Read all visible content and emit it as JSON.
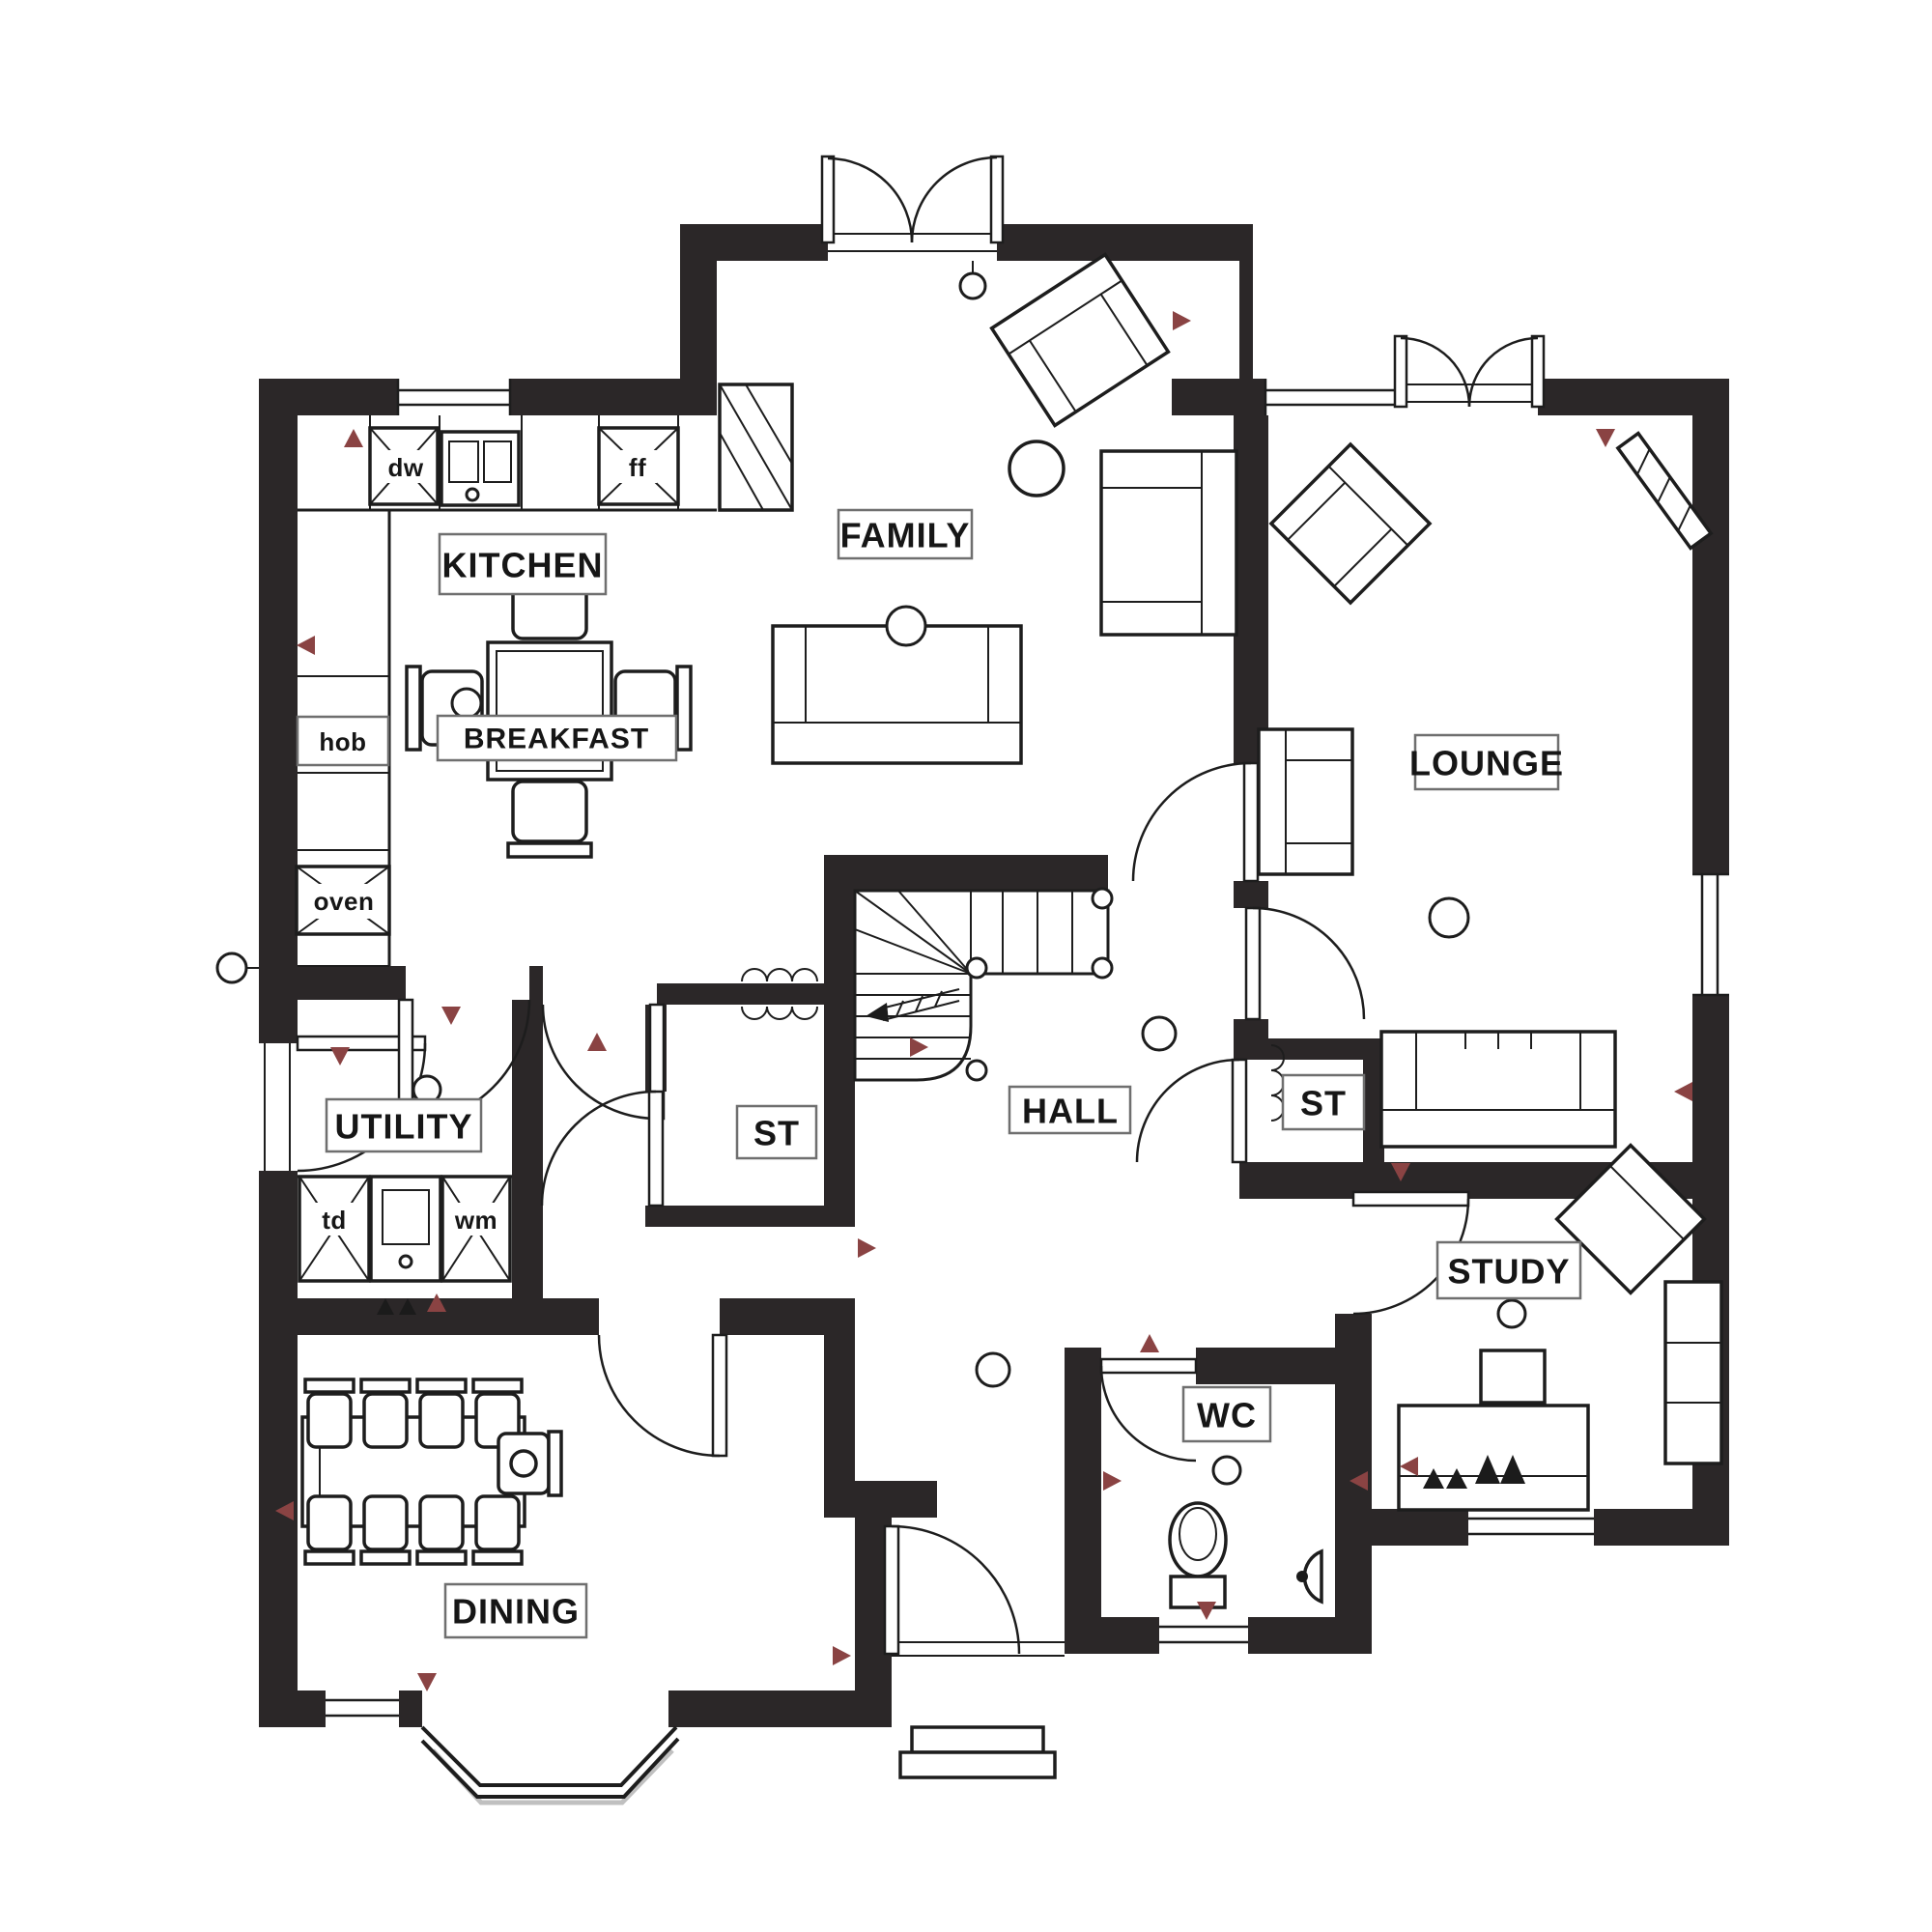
{
  "colors": {
    "wall": "#2b2728",
    "line": "#1d1d1d",
    "accent_marker": "#8a4343",
    "label_border": "#6f6f6f"
  },
  "rooms": [
    {
      "id": "kitchen",
      "label": "KITCHEN"
    },
    {
      "id": "breakfast",
      "label": "BREAKFAST"
    },
    {
      "id": "family",
      "label": "FAMILY"
    },
    {
      "id": "lounge",
      "label": "LOUNGE"
    },
    {
      "id": "utility",
      "label": "UTILITY"
    },
    {
      "id": "store-left",
      "label": "ST"
    },
    {
      "id": "store-right",
      "label": "ST"
    },
    {
      "id": "hall",
      "label": "HALL"
    },
    {
      "id": "wc",
      "label": "WC"
    },
    {
      "id": "dining",
      "label": "DINING"
    },
    {
      "id": "study",
      "label": "STUDY"
    }
  ],
  "appliances": [
    {
      "id": "hob",
      "label": "hob"
    },
    {
      "id": "oven",
      "label": "oven"
    },
    {
      "id": "dishwasher",
      "label": "dw"
    },
    {
      "id": "fridge-freezer",
      "label": "ff"
    },
    {
      "id": "tumble-dryer",
      "label": "td"
    },
    {
      "id": "washing-machine",
      "label": "wm"
    }
  ]
}
